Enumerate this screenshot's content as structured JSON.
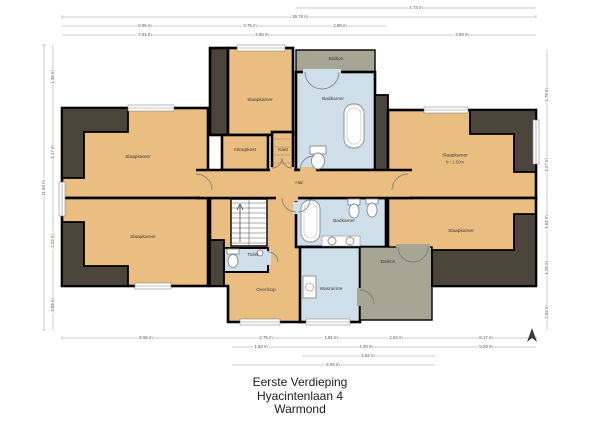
{
  "title": {
    "line1": "Eerste Verdieping",
    "line2": "Hyacintenlaan 4",
    "line3": "Warmond"
  },
  "rooms": {
    "slaapkamer_top_left": "Slaapkamer",
    "slaapkamer_bottom_left": "Slaapkamer",
    "slaapkamer_top_middle": "Slaapkamer",
    "inloopkast": "Inloopkast",
    "kast": "Kast",
    "badkamer_top": "Badkamer",
    "balkon_top": "Balkon",
    "hal": "Hal",
    "slaapkamer_right_top": "Slaapkamer",
    "slaapkamer_right_top_note": "h= 1.50m",
    "slaapkamer_right_bottom": "Slaapkamer",
    "badkamer_bottom": "Badkamer",
    "overloop": "Overloop",
    "toilet": "Toilet",
    "wasruimte": "Wasruimte",
    "balkon_bottom": "Balkon"
  },
  "dims": {
    "top": [
      "4.73 m",
      "26.76 m",
      "8.55 m",
      "3.75 m",
      "2.88 m",
      "7.91 m",
      "2.60 m",
      "3.50 m"
    ],
    "bottom": [
      "8.55 m",
      "2.75 m",
      "1.81 m",
      "2.84 m",
      "8.17 m",
      "1.83 m",
      "4.20 m",
      "5.29 m",
      "4.82 m",
      "6.94 m"
    ],
    "left": [
      "11.93 m",
      "1.35 m",
      "4.17 m",
      "2.22 m",
      "3.05 m"
    ],
    "right": [
      "2.78 m",
      "4.27 m",
      "1.62 m",
      "4.25 m",
      "2.62 m"
    ]
  },
  "colors": {
    "room_fill": "#eabd80",
    "wet_room_fill": "#cfdfea",
    "balcony_fill": "#a5a794",
    "roof_slope_fill": "#4a443b",
    "wall": "#000000",
    "dimension_line": "#999999"
  }
}
